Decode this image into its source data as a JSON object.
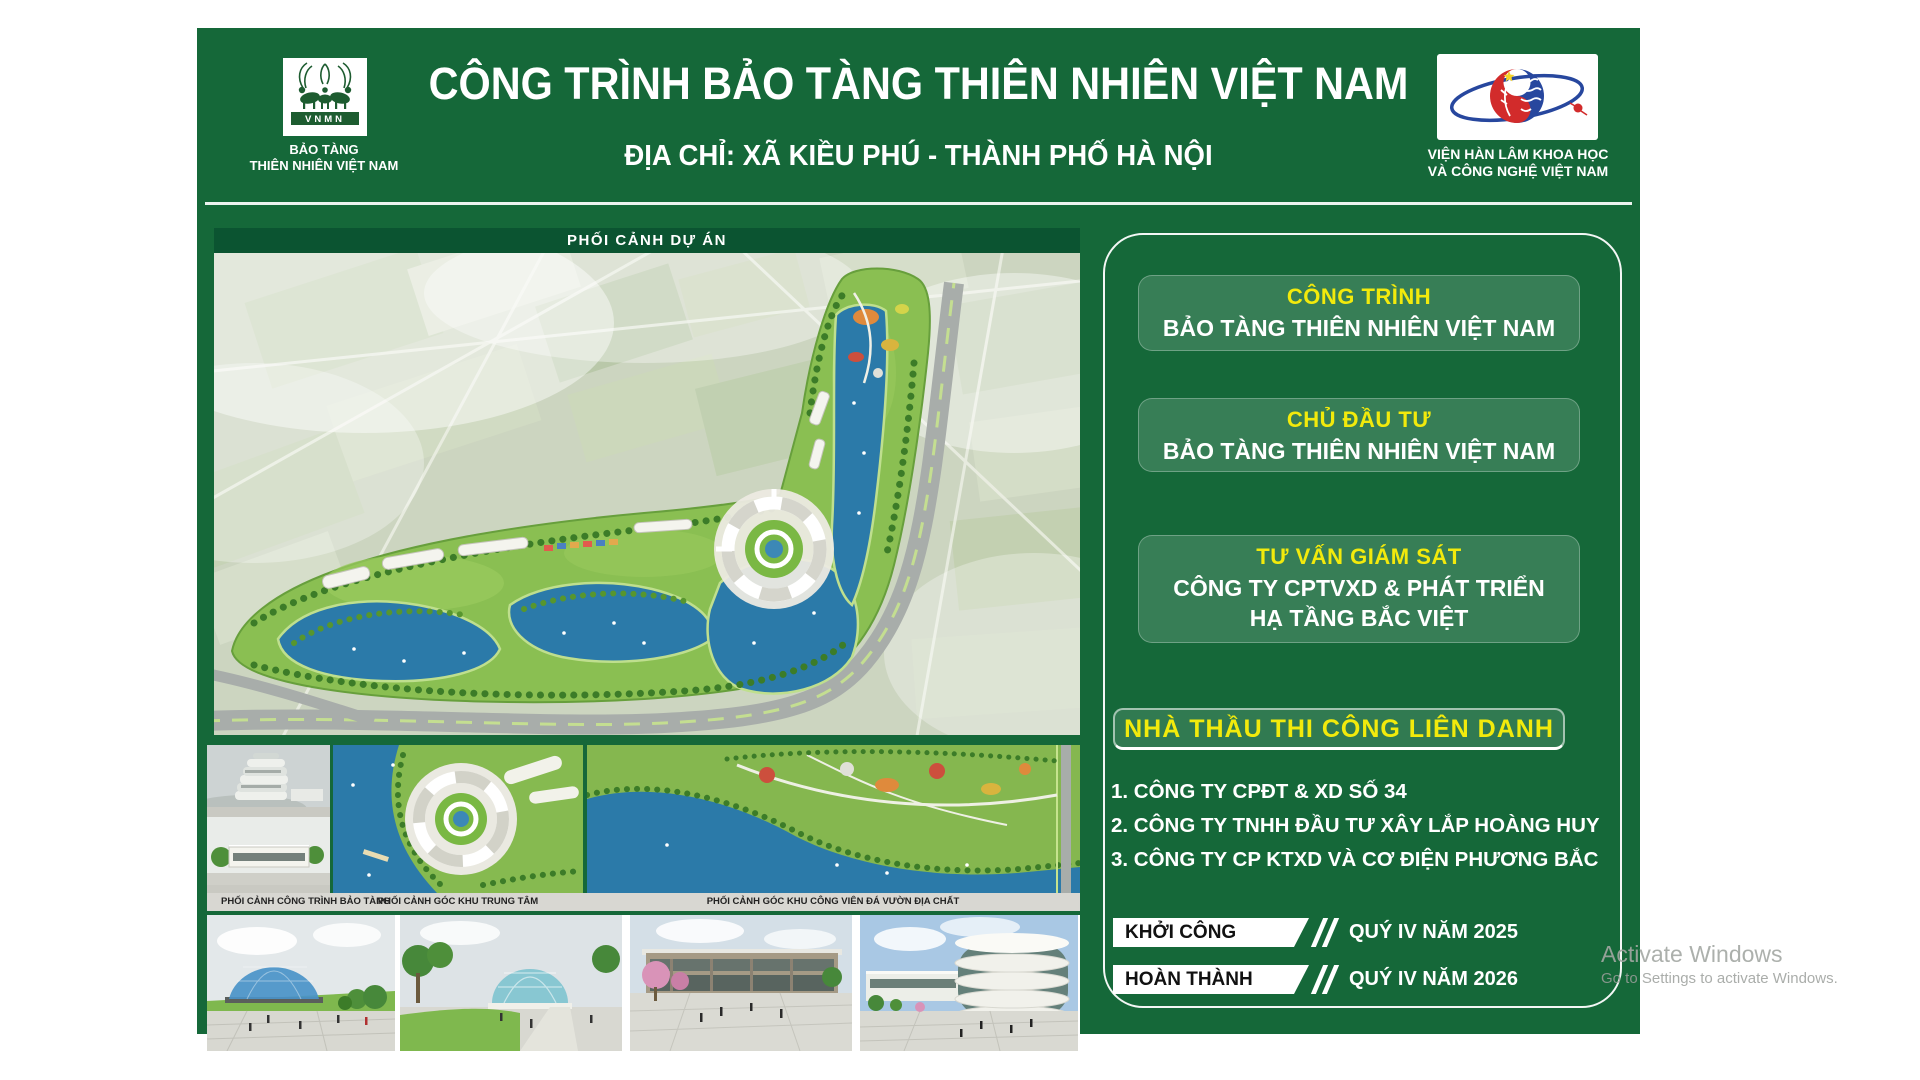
{
  "window": {
    "background": "#ffffff"
  },
  "watermark": {
    "line1": "Activate Windows",
    "line2": "Go to Settings to activate Windows."
  },
  "colors": {
    "board_green": "#156839",
    "band_dark_green": "#0b5431",
    "panel_box_green": "#3d7a57",
    "accent_yellow": "#f2ea0c",
    "caption_strip_gray": "#d8d7d2",
    "water_blue": "#2b7aa9",
    "site_green": "#8abf52"
  },
  "header": {
    "title": "CÔNG TRÌNH BẢO TÀNG THIÊN NHIÊN VIỆT NAM",
    "address": "ĐỊA CHỈ: XÃ KIỀU PHÚ - THÀNH PHỐ HÀ NỘI",
    "left_logo": {
      "acronym": "VNMN",
      "caption": [
        "BẢO TÀNG",
        "THIÊN NHIÊN VIỆT NAM"
      ]
    },
    "right_logo": {
      "caption": [
        "VIỆN HÀN LÂM KHOA HỌC",
        "VÀ CÔNG NGHỆ VIỆT NAM"
      ]
    }
  },
  "main_render": {
    "label": "PHỐI CẢNH DỰ ÁN"
  },
  "gallery": {
    "captions": [
      "PHỐI CẢNH CÔNG TRÌNH BẢO TÀNG",
      "PHỐI CẢNH GÓC KHU TRUNG TÂM",
      "PHỐI CẢNH GÓC KHU CÔNG VIÊN ĐÁ VƯỜN ĐỊA CHẤT"
    ]
  },
  "info_panel": {
    "boxes": [
      {
        "label": "CÔNG TRÌNH",
        "value": "BẢO TÀNG THIÊN NHIÊN VIỆT NAM"
      },
      {
        "label": "CHỦ ĐẦU TƯ",
        "value": "BẢO TÀNG THIÊN NHIÊN VIỆT NAM"
      },
      {
        "label": "TƯ VẤN GIÁM SÁT",
        "value": [
          "CÔNG TY CPTVXD & PHÁT TRIỂN",
          "HẠ TẦNG BẮC VIỆT"
        ]
      }
    ],
    "contractors": {
      "heading": "NHÀ THẦU THI CÔNG LIÊN DANH",
      "items": [
        "1. CÔNG TY CPĐT & XD SỐ 34",
        "2. CÔNG TY TNHH ĐẦU TƯ XÂY LẮP HOÀNG HUY",
        "3. CÔNG TY CP KTXD VÀ CƠ ĐIỆN PHƯƠNG BẮC"
      ]
    },
    "schedule": [
      {
        "label": "KHỞI CÔNG",
        "value": "QUÝ IV NĂM 2025"
      },
      {
        "label": "HOÀN THÀNH",
        "value": "QUÝ IV NĂM 2026"
      }
    ]
  }
}
